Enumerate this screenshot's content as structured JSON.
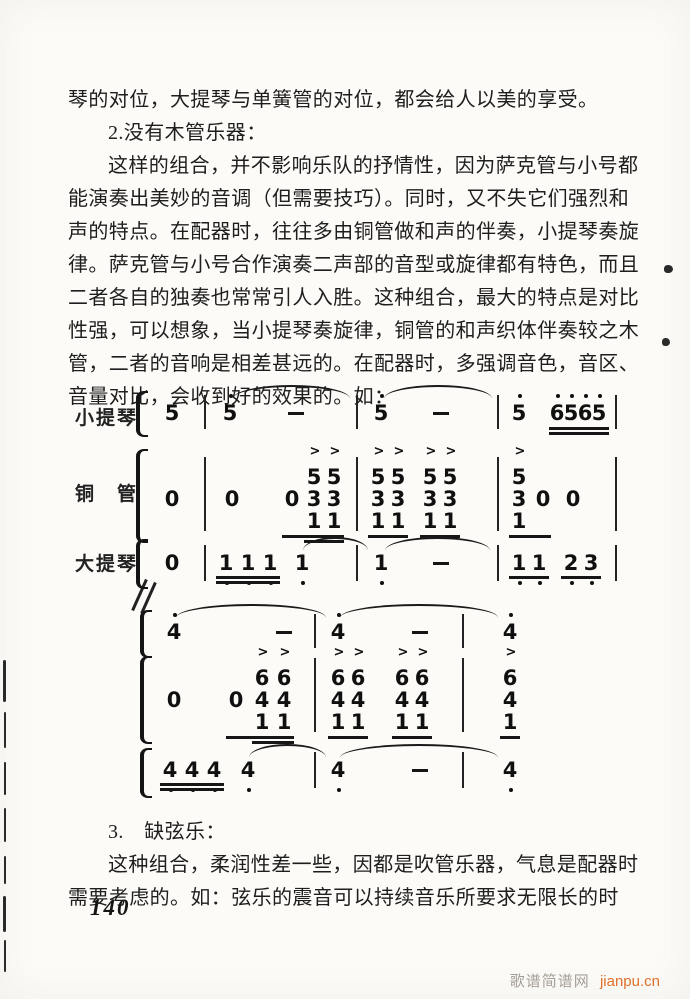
{
  "page": {
    "page_number": "140",
    "watermark": {
      "site_name": "歌谱简谱网",
      "url": "jianpu.cn",
      "site_color": "#a59e97",
      "url_color": "#e0702a"
    },
    "paper_color": "#fcfbf8",
    "ink_color": "#1e1e1e"
  },
  "text_top": {
    "lines": [
      {
        "indent": false,
        "text": "琴的对位，大提琴与单簧管的对位，都会给人以美的享受。"
      },
      {
        "indent": true,
        "text": "2.没有木管乐器："
      },
      {
        "indent": true,
        "text": "这样的组合，并不影响乐队的抒情性，因为萨克管与小号都"
      },
      {
        "indent": false,
        "text": "能演奏出美妙的音调（但需要技巧）。同时，又不失它们强烈和"
      },
      {
        "indent": false,
        "text": "声的特点。在配器时，往往多由铜管做和声的伴奏，小提琴奏旋"
      },
      {
        "indent": false,
        "text": "律。萨克管与小号合作演奏二声部的音型或旋律都有特色，而且"
      },
      {
        "indent": false,
        "text": "二者各自的独奏也常常引人入胜。这种组合，最大的特点是对比"
      },
      {
        "indent": false,
        "text": "性强，可以想象，当小提琴奏旋律，铜管的和声织体伴奏较之木"
      },
      {
        "indent": false,
        "text": "管，二者的音响是相差甚远的。在配器时，多强调音色，音区、"
      },
      {
        "indent": false,
        "text": "音量对比，会收到好的效果的。如："
      }
    ]
  },
  "text_bottom": {
    "lines": [
      {
        "indent": true,
        "text": "3.　缺弦乐："
      },
      {
        "indent": true,
        "text": "这种组合，柔润性差一些，因都是吹管乐器，气息是配器时"
      },
      {
        "indent": false,
        "text": "需要考虑的。如：弦乐的震音可以持续音乐所要求无限长的时"
      }
    ]
  },
  "score": {
    "notation": "jianpu",
    "systems": [
      {
        "top": 393,
        "height": 200,
        "staves": [
          {
            "label": "小提琴",
            "label_y": 10,
            "digit_y": 8,
            "bar_y1": 2,
            "bar_y2": 36,
            "bracket": {
              "x": 136,
              "y1": -2,
              "y2": 40
            },
            "tokens": [
              {
                "t": "n",
                "x": 166,
                "d": "5"
              },
              {
                "t": "bar",
                "x": 204
              },
              {
                "t": "n",
                "x": 224,
                "d": "5",
                "oa": 1
              },
              {
                "t": "dash",
                "x": 288
              },
              {
                "t": "bar",
                "x": 356
              },
              {
                "t": "n",
                "x": 375,
                "d": "5",
                "oa": 1
              },
              {
                "t": "dash",
                "x": 433
              },
              {
                "t": "bar",
                "x": 497
              },
              {
                "t": "n",
                "x": 513,
                "d": "5",
                "oa": 1
              },
              {
                "t": "n",
                "x": 551,
                "d": "6",
                "oa": 1
              },
              {
                "t": "n",
                "x": 565,
                "d": "5",
                "oa": 1
              },
              {
                "t": "n",
                "x": 579,
                "d": "6",
                "oa": 1
              },
              {
                "t": "n",
                "x": 593,
                "d": "5",
                "oa": 1
              },
              {
                "t": "bar",
                "x": 615
              }
            ],
            "slurs": [
              {
                "x1": 233,
                "x2": 350,
                "y": -8
              },
              {
                "x1": 384,
                "x2": 492,
                "y": -8
              }
            ],
            "ulines": [
              {
                "x1": 549,
                "x2": 609,
                "y": 34,
                "n": 2
              }
            ]
          },
          {
            "label": "铜　管",
            "label_y": 86,
            "digit_y": 94,
            "bar_y1": 64,
            "bar_y2": 138,
            "bracket": {
              "x": 136,
              "y1": 56,
              "y2": 146
            },
            "tokens": [
              {
                "t": "n",
                "x": 166,
                "d": "0"
              },
              {
                "t": "bar",
                "x": 204
              },
              {
                "t": "n",
                "x": 226,
                "d": "0"
              },
              {
                "t": "n",
                "x": 286,
                "d": "0"
              },
              {
                "t": "c",
                "x": 308,
                "ds": [
                  "5",
                  "3",
                  "1"
                ],
                "acc": true
              },
              {
                "t": "c",
                "x": 328,
                "ds": [
                  "5",
                  "3",
                  "1"
                ],
                "acc": true
              },
              {
                "t": "bar",
                "x": 356
              },
              {
                "t": "c",
                "x": 372,
                "ds": [
                  "5",
                  "3",
                  "1"
                ],
                "acc": true
              },
              {
                "t": "c",
                "x": 392,
                "ds": [
                  "5",
                  "3",
                  "1"
                ],
                "acc": true
              },
              {
                "t": "c",
                "x": 424,
                "ds": [
                  "5",
                  "3",
                  "1"
                ],
                "acc": true
              },
              {
                "t": "c",
                "x": 444,
                "ds": [
                  "5",
                  "3",
                  "1"
                ],
                "acc": true
              },
              {
                "t": "bar",
                "x": 497
              },
              {
                "t": "c",
                "x": 513,
                "ds": [
                  "5",
                  "3",
                  "1"
                ],
                "acc": true
              },
              {
                "t": "n",
                "x": 537,
                "d": "0"
              },
              {
                "t": "n",
                "x": 567,
                "d": "0"
              },
              {
                "t": "bar",
                "x": 615
              }
            ],
            "ulines": [
              {
                "x1": 282,
                "x2": 344,
                "y": 142
              },
              {
                "x1": 304,
                "x2": 344,
                "y": 147
              },
              {
                "x1": 368,
                "x2": 408,
                "y": 142
              },
              {
                "x1": 420,
                "x2": 460,
                "y": 142
              },
              {
                "x1": 509,
                "x2": 551,
                "y": 142
              }
            ]
          },
          {
            "label": "大提琴",
            "label_y": 156,
            "digit_y": 158,
            "bar_y1": 152,
            "bar_y2": 188,
            "bracket": {
              "x": 136,
              "y1": 146,
              "y2": 192
            },
            "tokens": [
              {
                "t": "n",
                "x": 166,
                "d": "0"
              },
              {
                "t": "bar",
                "x": 204
              },
              {
                "t": "n",
                "x": 220,
                "d": "1",
                "ob": 1
              },
              {
                "t": "n",
                "x": 242,
                "d": "1",
                "ob": 1
              },
              {
                "t": "n",
                "x": 264,
                "d": "1",
                "ob": 1
              },
              {
                "t": "n",
                "x": 296,
                "d": "1",
                "ob": 1
              },
              {
                "t": "bar",
                "x": 356
              },
              {
                "t": "n",
                "x": 375,
                "d": "1",
                "ob": 1
              },
              {
                "t": "dash",
                "x": 433
              },
              {
                "t": "bar",
                "x": 497
              },
              {
                "t": "n",
                "x": 513,
                "d": "1",
                "ob": 1
              },
              {
                "t": "n",
                "x": 533,
                "d": "1",
                "ob": 1
              },
              {
                "t": "n",
                "x": 565,
                "d": "2",
                "ob": 1
              },
              {
                "t": "n",
                "x": 585,
                "d": "3",
                "ob": 1
              },
              {
                "t": "bar",
                "x": 615
              }
            ],
            "ulines": [
              {
                "x1": 216,
                "x2": 280,
                "y": 183,
                "n": 2
              },
              {
                "x1": 509,
                "x2": 549,
                "y": 183
              },
              {
                "x1": 561,
                "x2": 601,
                "y": 183
              }
            ],
            "slurs": [
              {
                "x1": 303,
                "x2": 368,
                "y": 144
              },
              {
                "x1": 385,
                "x2": 490,
                "y": 144
              }
            ]
          }
        ]
      },
      {
        "top": 598,
        "height": 215,
        "staves": [
          {
            "label": "",
            "label_y": 0,
            "digit_y": 22,
            "bar_y1": 16,
            "bar_y2": 50,
            "bracket": {
              "x": 140,
              "y1": 12,
              "y2": 56
            },
            "tokens": [
              {
                "t": "n",
                "x": 168,
                "d": "4",
                "oa": 1
              },
              {
                "t": "dash",
                "x": 276
              },
              {
                "t": "bar",
                "x": 314
              },
              {
                "t": "n",
                "x": 332,
                "d": "4",
                "oa": 1
              },
              {
                "t": "dash",
                "x": 412
              },
              {
                "t": "bar",
                "x": 462
              },
              {
                "t": "n",
                "x": 504,
                "d": "4",
                "oa": 1
              }
            ],
            "slurs": [
              {
                "x1": 176,
                "x2": 326,
                "y": 6
              },
              {
                "x1": 340,
                "x2": 498,
                "y": 6
              }
            ]
          },
          {
            "label": "",
            "label_y": 0,
            "digit_y": 90,
            "bar_y1": 60,
            "bar_y2": 134,
            "bracket": {
              "x": 140,
              "y1": 58,
              "y2": 142
            },
            "tokens": [
              {
                "t": "n",
                "x": 168,
                "d": "0"
              },
              {
                "t": "n",
                "x": 230,
                "d": "0"
              },
              {
                "t": "c",
                "x": 256,
                "ds": [
                  "6",
                  "4",
                  "1"
                ],
                "acc": true
              },
              {
                "t": "c",
                "x": 278,
                "ds": [
                  "6",
                  "4",
                  "1"
                ],
                "acc": true
              },
              {
                "t": "bar",
                "x": 314
              },
              {
                "t": "c",
                "x": 332,
                "ds": [
                  "6",
                  "4",
                  "1"
                ],
                "acc": true
              },
              {
                "t": "c",
                "x": 352,
                "ds": [
                  "6",
                  "4",
                  "1"
                ],
                "acc": true
              },
              {
                "t": "c",
                "x": 396,
                "ds": [
                  "6",
                  "4",
                  "1"
                ],
                "acc": true
              },
              {
                "t": "c",
                "x": 416,
                "ds": [
                  "6",
                  "4",
                  "1"
                ],
                "acc": true
              },
              {
                "t": "bar",
                "x": 462
              },
              {
                "t": "c",
                "x": 504,
                "ds": [
                  "6",
                  "4",
                  "1"
                ],
                "acc": true
              }
            ],
            "ulines": [
              {
                "x1": 226,
                "x2": 294,
                "y": 138
              },
              {
                "x1": 252,
                "x2": 294,
                "y": 143
              },
              {
                "x1": 328,
                "x2": 368,
                "y": 138
              },
              {
                "x1": 392,
                "x2": 432,
                "y": 138
              },
              {
                "x1": 500,
                "x2": 520,
                "y": 138
              }
            ]
          },
          {
            "label": "",
            "label_y": 0,
            "digit_y": 160,
            "bar_y1": 154,
            "bar_y2": 190,
            "bracket": {
              "x": 140,
              "y1": 150,
              "y2": 196
            },
            "tokens": [
              {
                "t": "n",
                "x": 164,
                "d": "4",
                "ob": 1
              },
              {
                "t": "n",
                "x": 186,
                "d": "4",
                "ob": 1
              },
              {
                "t": "n",
                "x": 208,
                "d": "4",
                "ob": 1
              },
              {
                "t": "n",
                "x": 242,
                "d": "4",
                "ob": 1
              },
              {
                "t": "bar",
                "x": 314
              },
              {
                "t": "n",
                "x": 332,
                "d": "4",
                "ob": 1
              },
              {
                "t": "dash",
                "x": 412
              },
              {
                "t": "bar",
                "x": 462
              },
              {
                "t": "n",
                "x": 504,
                "d": "4",
                "ob": 1
              }
            ],
            "ulines": [
              {
                "x1": 160,
                "x2": 224,
                "y": 185,
                "n": 2
              }
            ],
            "slurs": [
              {
                "x1": 249,
                "x2": 326,
                "y": 146
              },
              {
                "x1": 340,
                "x2": 498,
                "y": 146
              }
            ]
          }
        ]
      }
    ]
  }
}
